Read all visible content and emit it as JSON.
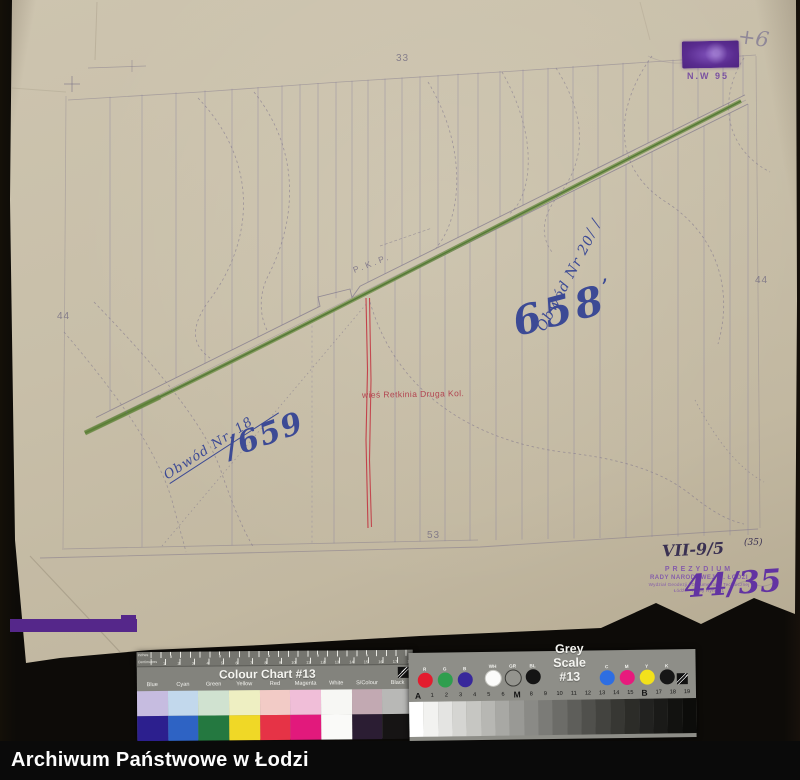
{
  "page": {
    "footer": "Archiwum Państwowe w Łodzi"
  },
  "map": {
    "sheet_numbers": {
      "top": "33",
      "left": "44",
      "right": "44",
      "bottom": "53"
    },
    "railway_label": "P.K.P.",
    "village_label": "wieś Retkinia Druga Kol.",
    "hand_658": "658",
    "hand_658_mark": "’",
    "hand_obwod20": "Obwód Nr 20",
    "hand_obwod18": "Obwód Nr. 18",
    "hand_659": "/659",
    "hand_plus": "+6",
    "stamp_code": "N.W 95",
    "ref_main": "VII-9/5",
    "ref_sup": "(35)",
    "stamp_bottom": {
      "l1": "PREZYDIUM",
      "l2": "RADY NARODOWEJ m. ŁODZI",
      "l3": "Wydział Geodezji i Dokumentacji Technicznej",
      "l4": "Łódź — Nowy Rynek 1",
      "hand": "44/35"
    }
  },
  "colour_chart": {
    "title": "Colour Chart #13",
    "ruler_top_label": "Inches",
    "ruler_bottom_label": "Centimetres",
    "cm_labels": [
      "1",
      "2",
      "3",
      "4",
      "5",
      "6",
      "7",
      "8",
      "9",
      "10",
      "11",
      "12",
      "13",
      "14",
      "15",
      "16",
      "17",
      "18"
    ],
    "columns": [
      {
        "label": "Blue",
        "light": "#c6bce0",
        "full": "#2c1f8e"
      },
      {
        "label": "Cyan",
        "light": "#c2d8ec",
        "full": "#2e63c4"
      },
      {
        "label": "Green",
        "light": "#d0e2d0",
        "full": "#247840"
      },
      {
        "label": "Yellow",
        "light": "#eeefc2",
        "full": "#f0d826"
      },
      {
        "label": "Red",
        "light": "#f2cbc6",
        "full": "#e63346"
      },
      {
        "label": "Magenta",
        "light": "#f0bed8",
        "full": "#e2197c"
      },
      {
        "label": "White",
        "light": "#f7f7f4",
        "full": "#fafaf8"
      },
      {
        "label": "S/Colour",
        "light": "#c2a9b2",
        "full": "#2b1d33"
      },
      {
        "label": "Black",
        "light": "#b8b8b6",
        "full": "#161414"
      }
    ]
  },
  "grey_scale": {
    "title": "Grey Scale #13",
    "left_circles": [
      {
        "label": "R",
        "color": "#e31c2e"
      },
      {
        "label": "G",
        "color": "#2f9e4e"
      },
      {
        "label": "B",
        "color": "#38289b"
      },
      {
        "label": "WH",
        "color": "#fcfcfa"
      },
      {
        "label": "GR",
        "color": "#94948e"
      },
      {
        "label": "BL",
        "color": "#141414"
      }
    ],
    "right_circles": [
      {
        "label": "C",
        "color": "#2e6ee2"
      },
      {
        "label": "M",
        "color": "#e81a7d"
      },
      {
        "label": "Y",
        "color": "#f2e11c"
      },
      {
        "label": "K",
        "color": "#161616"
      }
    ],
    "scale_labels": [
      "A",
      "1",
      "2",
      "3",
      "4",
      "5",
      "6",
      "M",
      "8",
      "9",
      "10",
      "11",
      "12",
      "13",
      "14",
      "15",
      "B",
      "17",
      "18",
      "19"
    ],
    "scale_colors": [
      "#ffffff",
      "#f2f2f0",
      "#e4e4e2",
      "#d5d5d2",
      "#c6c6c2",
      "#b7b7b3",
      "#a8a8a4",
      "#999995",
      "#8a8a86",
      "#7b7b77",
      "#6c6c68",
      "#5e5e5a",
      "#50504c",
      "#43433f",
      "#373733",
      "#2c2c28",
      "#222220",
      "#1a1a18",
      "#121210",
      "#0c0c0a"
    ]
  }
}
